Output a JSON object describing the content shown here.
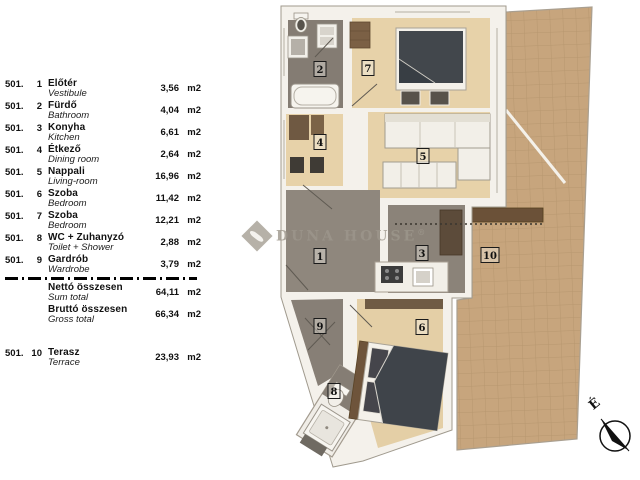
{
  "legend": {
    "rows": [
      {
        "code": "501.",
        "num": "1",
        "name_hu": "Előtér",
        "name_en": "Vestibule",
        "area": "3,56",
        "unit": "m2"
      },
      {
        "code": "501.",
        "num": "2",
        "name_hu": "Fürdő",
        "name_en": "Bathroom",
        "area": "4,04",
        "unit": "m2"
      },
      {
        "code": "501.",
        "num": "3",
        "name_hu": "Konyha",
        "name_en": "Kitchen",
        "area": "6,61",
        "unit": "m2"
      },
      {
        "code": "501.",
        "num": "4",
        "name_hu": "Étkező",
        "name_en": "Dining room",
        "area": "2,64",
        "unit": "m2"
      },
      {
        "code": "501.",
        "num": "5",
        "name_hu": "Nappali",
        "name_en": "Living-room",
        "area": "16,96",
        "unit": "m2"
      },
      {
        "code": "501.",
        "num": "6",
        "name_hu": "Szoba",
        "name_en": "Bedroom",
        "area": "11,42",
        "unit": "m2"
      },
      {
        "code": "501.",
        "num": "7",
        "name_hu": "Szoba",
        "name_en": "Bedroom",
        "area": "12,21",
        "unit": "m2"
      },
      {
        "code": "501.",
        "num": "8",
        "name_hu": "WC + Zuhanyzó",
        "name_en": "Toilet + Shower",
        "area": "2,88",
        "unit": "m2"
      },
      {
        "code": "501.",
        "num": "9",
        "name_hu": "Gardrób",
        "name_en": "Wardrobe",
        "area": "3,79",
        "unit": "m2"
      },
      {
        "code": "501.",
        "num": "10",
        "name_hu": "Terasz",
        "name_en": "Terrace",
        "area": "23,93",
        "unit": "m2"
      }
    ],
    "totals": [
      {
        "name_hu": "Nettó összesen",
        "name_en": "Sum total",
        "area": "64,11",
        "unit": "m2"
      },
      {
        "name_hu": "Bruttó összesen",
        "name_en": "Gross total",
        "area": "66,34",
        "unit": "m2"
      }
    ]
  },
  "plan": {
    "room_numbers": [
      "1",
      "2",
      "3",
      "4",
      "5",
      "6",
      "7",
      "8",
      "9",
      "10"
    ]
  },
  "watermark": {
    "text": "DUNA HOUSE",
    "reg": "®"
  },
  "compass": {
    "north_label": "É"
  },
  "colors": {
    "wood_floor": "#e7d2a9",
    "tile_floor": "#c7a57d",
    "dark_floor": "#8b8379",
    "wall": "#f4f1eb",
    "bed": "#40464b",
    "watermark": "#9d978c"
  }
}
